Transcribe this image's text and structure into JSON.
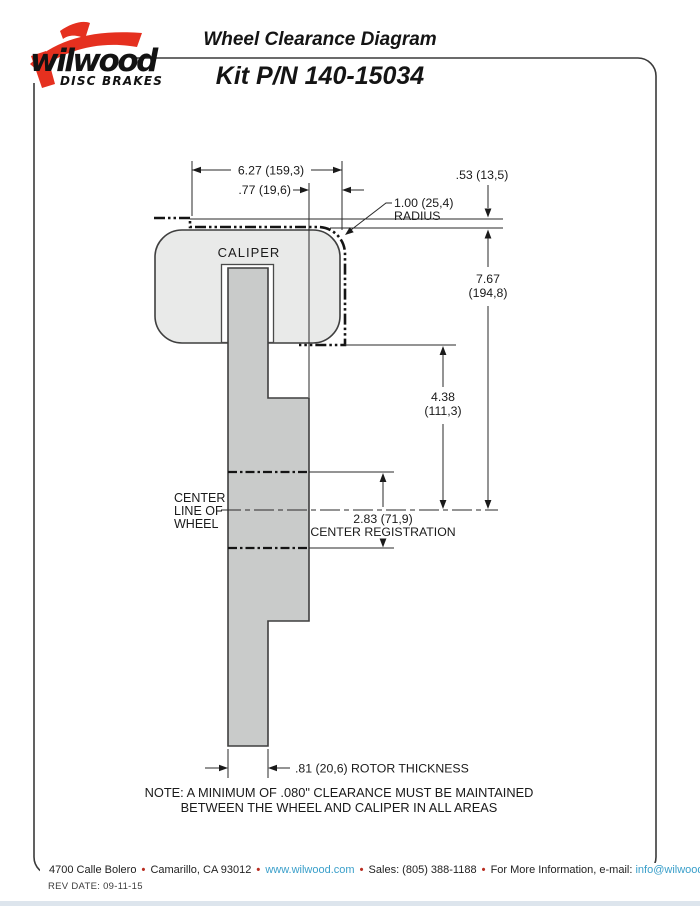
{
  "header": {
    "logo": {
      "brand": "wilwood",
      "tagline": "DISC BRAKES"
    },
    "title": "Wheel Clearance Diagram",
    "kit": "Kit P/N 140-15034"
  },
  "diagram": {
    "caliper_label": "CALIPER",
    "dim_width": "6.27 (159,3)",
    "dim_lip": ".77 (19,6)",
    "dim_radius_value": "1.00 (25,4)",
    "dim_radius_word": "RADIUS",
    "dim_clearance": ".53 (13,5)",
    "dim_overall_1": "7.67",
    "dim_overall_2": "(194,8)",
    "dim_depth_1": "4.38",
    "dim_depth_2": "(111,3)",
    "dim_center_reg_value": "2.83 (71,9)",
    "dim_center_reg_label": "CENTER REGISTRATION",
    "dim_rotor_thickness": ".81 (20,6) ROTOR THICKNESS",
    "centerline_1": "CENTER",
    "centerline_2": "LINE OF",
    "centerline_3": "WHEEL",
    "note_1": "NOTE: A MINIMUM OF .080\" CLEARANCE MUST BE MAINTAINED",
    "note_2": "BETWEEN THE WHEEL AND CALIPER IN ALL AREAS"
  },
  "footer": {
    "address": "4700 Calle Bolero",
    "city": "Camarillo, CA 93012",
    "website": "www.wilwood.com",
    "sales": "Sales: (805) 388-1188",
    "info": "For More Information, e-mail:",
    "email": "info@wilwood.com",
    "bullet": "•",
    "rev": "REV DATE:  09-11-15"
  },
  "colors": {
    "accent_red": "#e5301f",
    "link_blue": "#3a9fca",
    "caliper_fill": "#e9eae9",
    "rotor_fill": "#c9cbca",
    "line": "#2a2a2a"
  }
}
